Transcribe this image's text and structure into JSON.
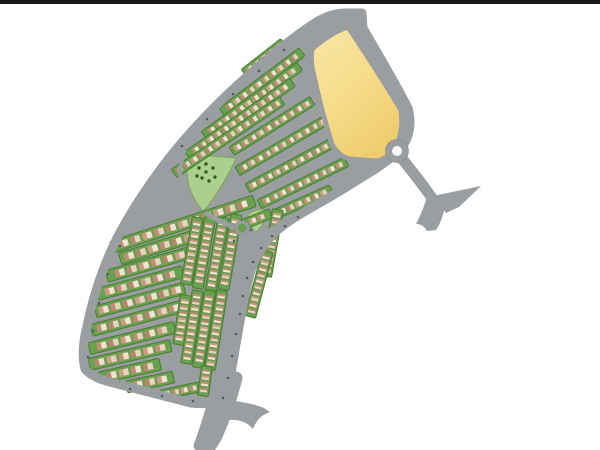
{
  "scene": {
    "description": "Residential community master plan site map, letterboxed photo on white background",
    "letterbox_color": "#191919",
    "background": "#ffffff"
  },
  "palette": {
    "road": "#9b9ea0",
    "road_dark": "#84878a",
    "green": "#69a24e",
    "green_dark": "#447d2e",
    "park": "#accf8e",
    "park_edge": "#7aa85c",
    "tree": "#2e5c21",
    "yellow_light": "#f9e7a6",
    "yellow_mid": "#f6dc8a",
    "yellow_deep": "#eecd6e",
    "house_bodies": [
      "#eee4d0",
      "#e3d6bd"
    ],
    "house_roofs": [
      "#bf8e74",
      "#b3886b",
      "#c99e82"
    ],
    "house_stroke": "#8d8070",
    "roundabout_center": "#f7f8f8",
    "dot": "#55595d",
    "white": "#ffffff"
  },
  "site": {
    "name": "curved-residential-band",
    "outline": "M345,13 L362,13 L363,28 C379,56 396,84 408,108 C412,122 410,138 401,148 C394,156 386,162 377,168 L340,191 C315,206 295,216 280,228 C266,239 256,254 250,274 C244,296 240,322 235,350 C231,376 226,398 219,418 C215,431 211,441 207,449 L198,446 C203,432 208,417 212,402 C206,404 199,404 191,403 L106,381 C96,378 89,374 85,369 C82,357 83,342 87,326 C93,297 103,266 117,238 C131,211 150,182 173,153 C196,125 223,97 252,72 C275,52 300,32 318,21 C327,16 336,13 345,13 Z",
    "boundary_road_width": 9
  },
  "parcels": [
    {
      "name": "yellow-development-parcel",
      "d": "M312,49 C325,38 338,30 348,27 C362,48 381,77 401,110 C403,124 401,137 396,146 C391,155 384,160 376,161 L350,159 C341,157 334,150 331,141 C325,122 318,95 313,72 C311,63 311,55 312,49 Z",
      "road_border_width": 5
    }
  ],
  "parks": [
    {
      "name": "triangular-park",
      "d": "M186,154 L236,158 C231,170 222,186 212,200 C209,205 206,209 203,211 C198,206 193,198 189,186 C187,176 186,164 186,154 Z"
    },
    {
      "name": "pocket-green",
      "d": "M248,214 C254,210 262,208 268,211 C266,219 262,227 256,232 C251,228 248,221 248,214 Z"
    }
  ],
  "house_kinds": {
    "row-sm": {
      "strip_w": 10,
      "house_w": 7,
      "house_h": 5.4,
      "pitch": 9
    },
    "row-md": {
      "strip_w": 12,
      "house_w": 10,
      "house_h": 7,
      "pitch": 12.5
    },
    "col-dense": {
      "strip_w": 11,
      "house_w": 4.4,
      "house_h": 7.6,
      "pitch": 6.2
    }
  },
  "blocks": [
    {
      "id": "T1",
      "cx": 264,
      "cy": 58,
      "len": 50,
      "rot": -38,
      "kind": "row-sm"
    },
    {
      "id": "T2",
      "cx": 262,
      "cy": 82,
      "len": 100,
      "rot": -37,
      "kind": "row-sm"
    },
    {
      "id": "T3",
      "cx": 252,
      "cy": 101,
      "len": 118,
      "rot": -36,
      "kind": "row-sm"
    },
    {
      "id": "T4",
      "cx": 240,
      "cy": 119,
      "len": 128,
      "rot": -35,
      "kind": "row-sm"
    },
    {
      "id": "T5",
      "cx": 228,
      "cy": 137,
      "len": 130,
      "rot": -34,
      "kind": "row-sm"
    },
    {
      "id": "T6",
      "cx": 272,
      "cy": 126,
      "len": 95,
      "rot": -32,
      "kind": "row-sm"
    },
    {
      "id": "T7",
      "cx": 283,
      "cy": 145,
      "len": 105,
      "rot": -30,
      "kind": "row-sm"
    },
    {
      "id": "T8",
      "cx": 293,
      "cy": 164,
      "len": 103,
      "rot": -28,
      "kind": "row-sm"
    },
    {
      "id": "T9",
      "cx": 303,
      "cy": 183,
      "len": 97,
      "rot": -26,
      "kind": "row-sm"
    },
    {
      "id": "T10",
      "cx": 303,
      "cy": 202,
      "len": 62,
      "rot": -24,
      "kind": "row-sm"
    },
    {
      "id": "T11",
      "cx": 257,
      "cy": 219,
      "len": 30,
      "rot": -22,
      "kind": "row-sm"
    },
    {
      "id": "M1",
      "cx": 183,
      "cy": 224,
      "len": 150,
      "rot": -18,
      "kind": "row-md"
    },
    {
      "id": "M2",
      "cx": 165,
      "cy": 245,
      "len": 94,
      "rot": -17,
      "kind": "row-md"
    },
    {
      "id": "M3",
      "cx": 150,
      "cy": 264,
      "len": 90,
      "rot": -16,
      "kind": "row-md"
    },
    {
      "id": "M4",
      "cx": 140,
      "cy": 283,
      "len": 88,
      "rot": -15,
      "kind": "row-md"
    },
    {
      "id": "M5",
      "cx": 140,
      "cy": 300,
      "len": 92,
      "rot": -15,
      "kind": "row-md"
    },
    {
      "id": "M6",
      "cx": 138,
      "cy": 318,
      "len": 96,
      "rot": -15,
      "kind": "row-md"
    },
    {
      "id": "M7",
      "cx": 132,
      "cy": 338,
      "len": 88,
      "rot": -14,
      "kind": "row-md"
    },
    {
      "id": "M8",
      "cx": 130,
      "cy": 355,
      "len": 84,
      "rot": -13,
      "kind": "row-md"
    },
    {
      "id": "M9",
      "cx": 130,
      "cy": 371,
      "len": 62,
      "rot": -13,
      "kind": "row-md"
    },
    {
      "id": "M10",
      "cx": 150,
      "cy": 382,
      "len": 48,
      "rot": -12,
      "kind": "row-md"
    },
    {
      "id": "M11",
      "cx": 180,
      "cy": 391,
      "len": 40,
      "rot": -12,
      "kind": "row-sm"
    },
    {
      "id": "DU1",
      "cx": 272,
      "cy": 243,
      "len": 68,
      "rot": 100,
      "kind": "col-dense"
    },
    {
      "id": "DU2",
      "cx": 259,
      "cy": 284,
      "len": 68,
      "rot": 105,
      "kind": "col-dense"
    },
    {
      "id": "DA",
      "cx": 230,
      "cy": 252,
      "len": 76,
      "rot": 100,
      "kind": "col-dense"
    },
    {
      "id": "DB",
      "cx": 217,
      "cy": 254,
      "len": 74,
      "rot": 100,
      "kind": "col-dense"
    },
    {
      "id": "DC",
      "cx": 204,
      "cy": 253,
      "len": 72,
      "rot": 100,
      "kind": "col-dense"
    },
    {
      "id": "DD",
      "cx": 192,
      "cy": 251,
      "len": 68,
      "rot": 100,
      "kind": "col-dense"
    },
    {
      "id": "DE",
      "cx": 216,
      "cy": 330,
      "len": 80,
      "rot": 99,
      "kind": "col-dense"
    },
    {
      "id": "DF",
      "cx": 204,
      "cy": 329,
      "len": 78,
      "rot": 99,
      "kind": "col-dense"
    },
    {
      "id": "DG",
      "cx": 192,
      "cy": 327,
      "len": 74,
      "rot": 99,
      "kind": "col-dense"
    },
    {
      "id": "DH",
      "cx": 182,
      "cy": 320,
      "len": 50,
      "rot": 99,
      "kind": "col-dense"
    },
    {
      "id": "DI",
      "cx": 205,
      "cy": 381,
      "len": 30,
      "rot": 98,
      "kind": "col-dense"
    }
  ],
  "roads": [
    {
      "name": "collector-road-inner",
      "d": "M300,213 C278,224 260,236 251,252 C243,270 239,296 235,322 C232,348 228,372 222,394",
      "width": 6
    },
    {
      "name": "park-street",
      "d": "M207,214 C222,223 234,228 248,231 C256,233 262,236 266,240",
      "width": 5
    },
    {
      "name": "park-west-street",
      "d": "M184,151 C178,170 179,190 187,209",
      "width": 4
    }
  ],
  "exterior_roads": [
    {
      "name": "entry-road-northeast",
      "d": "M399,155 C412,171 424,186 434,201",
      "width": 11
    },
    {
      "name": "south-approach-road",
      "d": "M236,378 C231,398 224,418 216,436 C213,441 210,446 207,450",
      "width": 13
    },
    {
      "name": "northeast-trumpet-wedge",
      "fill_d": "M433,196 L481,186 L459,207 L446,213 Z"
    },
    {
      "name": "northeast-road-tail",
      "fill_d": "M427,197 L446,201 C444,213 441,223 436,230 L427,231 C424,226 421,224 416,224 C420,216 424,207 427,197 Z"
    },
    {
      "name": "south-trumpet-ramp",
      "fill_d": "M225,399 C240,402 252,403 264,408 L270,412 C262,415 257,419 253,429 C248,423 240,419 229,420 Z"
    }
  ],
  "roundabouts": [
    {
      "name": "entry-roundabout",
      "cx": 397,
      "cy": 151,
      "r_outer": 11.5,
      "r_inner": 5,
      "inner": "white"
    },
    {
      "name": "mini-roundabout",
      "cx": 242,
      "cy": 228,
      "r_outer": 7.5,
      "r_inner": 4.5,
      "inner": "green"
    }
  ],
  "trees": [
    [
      199,
      168
    ],
    [
      206,
      172
    ],
    [
      213,
      168
    ],
    [
      202,
      178
    ],
    [
      209,
      181
    ],
    [
      197,
      176
    ],
    [
      215,
      177
    ],
    [
      206,
      164
    ]
  ],
  "dots": [
    [
      298,
      217
    ],
    [
      285,
      226
    ],
    [
      272,
      236
    ],
    [
      261,
      248
    ],
    [
      253,
      262
    ],
    [
      247,
      278
    ],
    [
      243,
      296
    ],
    [
      240,
      314
    ],
    [
      236,
      334
    ],
    [
      232,
      356
    ],
    [
      228,
      378
    ],
    [
      223,
      398
    ],
    [
      251,
      230
    ],
    [
      234,
      241
    ],
    [
      120,
      246
    ],
    [
      108,
      274
    ],
    [
      99,
      303
    ],
    [
      93,
      331
    ],
    [
      88,
      357
    ],
    [
      130,
      389
    ],
    [
      162,
      396
    ],
    [
      193,
      401
    ],
    [
      182,
      146
    ],
    [
      207,
      119
    ],
    [
      233,
      94
    ],
    [
      259,
      71
    ],
    [
      284,
      50
    ]
  ]
}
